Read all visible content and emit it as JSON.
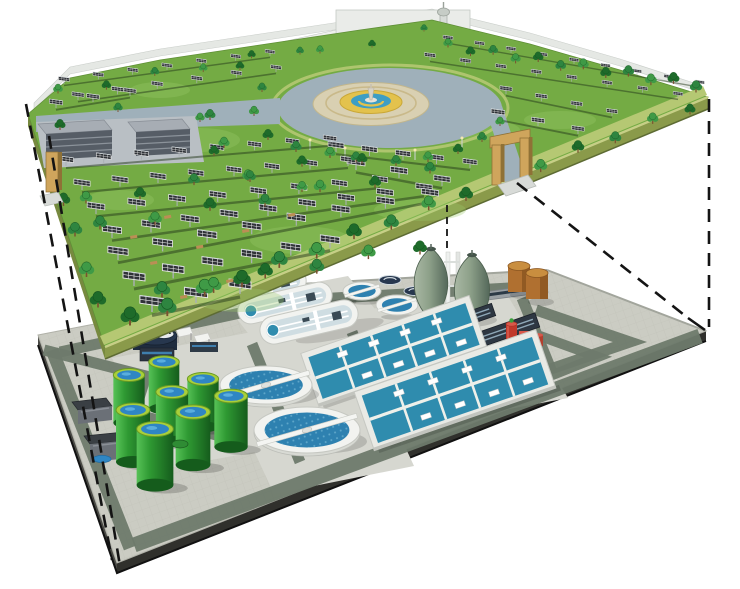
{
  "illustration": {
    "type": "exploded-axonometric-diagram",
    "subject": "solar park built on the roof deck of an underground wastewater treatment plant",
    "upper_layer": {
      "name": "rooftop-solar-park",
      "components": {
        "solar_panel_arrays": 98,
        "trees": 70,
        "central_plaza_fountain": 1,
        "observation_tower": 1,
        "service_buildings": 2,
        "entrance_gates": 2
      }
    },
    "lower_layer": {
      "name": "underground-wastewater-treatment-plant",
      "components": {
        "green_digester_tanks": 8,
        "egg_digesters": 2,
        "brown_storage_tanks": 2,
        "oxidation_ditches": 3,
        "large_circular_clarifiers": 2,
        "small_circular_clarifiers": 2,
        "gravity_thickeners": 2,
        "aeration_basin_blocks": 2,
        "blower_buildings": 2,
        "red_pump_unit": 1,
        "gas_holder": 1,
        "site_buildings": 2
      }
    },
    "connection": {
      "style": "dashed",
      "line_count": 5
    }
  },
  "colors": {
    "background": "#ffffff",
    "dash": "#141414",
    "park_grass": "#74ab44",
    "park_grass_light": "#9cc96a",
    "park_side": "#8a9a4a",
    "park_side_left": "#77893f",
    "park_side_light": "#c6cf86",
    "park_side_dark": "#5d6b33",
    "park_path": "#b5c873",
    "road_gray": "#9fb0ba",
    "plaza_pave": "#d9d0b2",
    "plaza_ring": "#c9b98a",
    "fountain_yellow": "#e3c24d",
    "fountain_blue": "#3e9ec4",
    "tree1": "#1e6b2a",
    "tree2": "#2e8540",
    "tree3": "#3f9a46",
    "trunk": "#7a5230",
    "panel_dark": "#2f3237",
    "panel_frame": "#e8e8e8",
    "panel_post": "#aab0b4",
    "row_shadow": "#263a1c",
    "bld_roof": "#a7adb4",
    "bld_face": "#565d66",
    "bld_stripe": "#8b929a",
    "bld_pad": "#b9bfc4",
    "gate_tan": "#cfa55c",
    "gate_dark": "#8f7136",
    "backdrop": "#e3e6e2",
    "backdrop_edge": "#c4c9c4",
    "paving": "#cbccc3",
    "paving_line": "#b7b8ae",
    "pad": "#d6d7d0",
    "road": "#6e7a6c",
    "side_dark": "#30302c",
    "side_mid": "#494944",
    "white_tank": "#f2f3f0",
    "white_tank_edge": "#c6c8c2",
    "white_shade": "#d8dad4",
    "water": "#2e81b0",
    "water_dot": "#79bcd8",
    "lane": "#cfdde2",
    "basin_blue": "#2f8cae",
    "basin_frame": "#e9eae5",
    "gt_light": "#57c257",
    "gt_mid": "#2f9a33",
    "gt_dark": "#155c1c",
    "gt_rim": "#a8cf3a",
    "gt_top": "#2f86c4",
    "egg_light": "#a9b8a4",
    "egg_mid": "#8da089",
    "egg_dark": "#54685a",
    "brown": "#b07030",
    "brown_dark": "#8a5520",
    "brown_top": "#c98e3f",
    "navy": "#27374e",
    "navy_dark": "#1f2c3e",
    "red": "#c0392b",
    "red_dark": "#a93226",
    "red_hi": "#d9584a",
    "dark_bld": "#2e3742",
    "dark_bld_stripe": "#8fa8b8",
    "bench": "#bb8e55"
  }
}
